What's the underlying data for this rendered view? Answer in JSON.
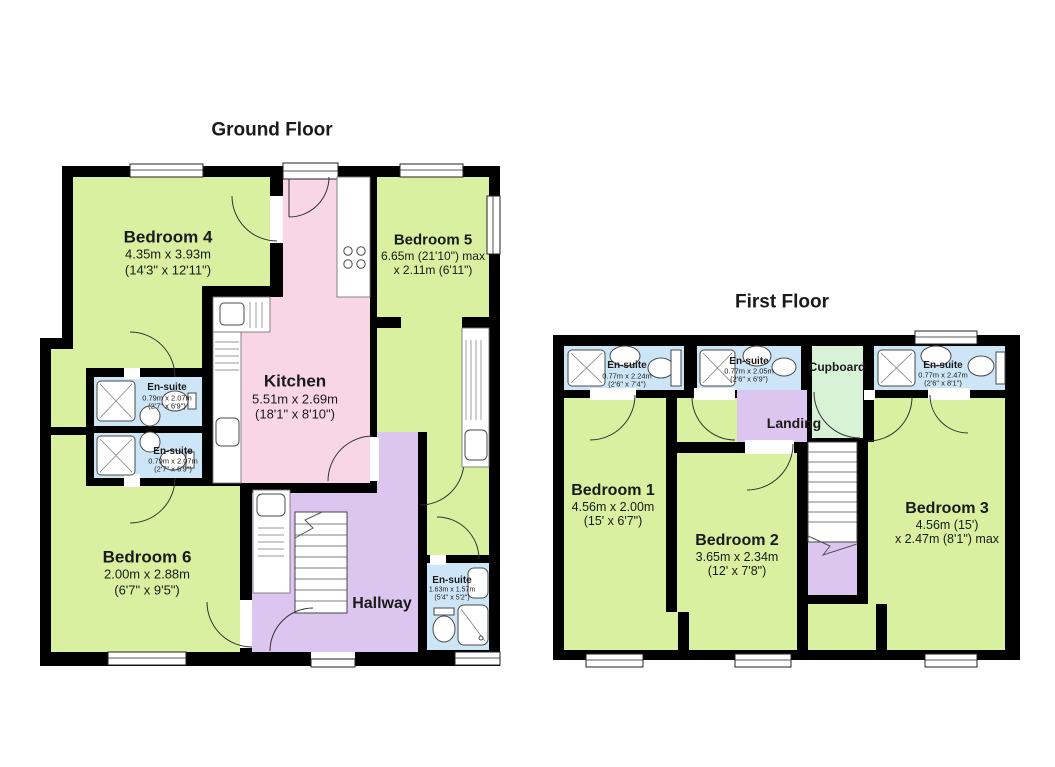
{
  "palette": {
    "room_green": "#d9f0a0",
    "kitchen_pink": "#f8d6e6",
    "hall_purple": "#dcc6f0",
    "ensuite_blue": "#cde6f7",
    "cupboard_mint": "#d8f2d8",
    "wall_black": "#000000"
  },
  "ground": {
    "title": "Ground Floor",
    "rooms": {
      "bedroom4": {
        "name": "Bedroom 4",
        "metric": "4.35m x 3.93m",
        "imperial": "(14'3\" x 12'11\")"
      },
      "bedroom5": {
        "name": "Bedroom 5",
        "metric": "6.65m (21'10\") max",
        "imperial": "x 2.11m (6'11\")"
      },
      "kitchen": {
        "name": "Kitchen",
        "metric": "5.51m x 2.69m",
        "imperial": "(18'1\" x 8'10\")"
      },
      "ensuite_top": {
        "name": "En-suite",
        "metric": "0.79m x 2.07m",
        "imperial": "(2'7\" x 6'9\")"
      },
      "ensuite_bottom": {
        "name": "En-suite",
        "metric": "0.79m x 2.07m",
        "imperial": "(2'7\" x 6'9\")"
      },
      "bedroom6": {
        "name": "Bedroom 6",
        "metric": "2.00m x 2.88m",
        "imperial": "(6'7\" x 9'5\")"
      },
      "hallway": {
        "name": "Hallway"
      },
      "ensuite_hall": {
        "name": "En-suite",
        "metric": "1.63m x 1.57m",
        "imperial": "(5'4\" x 5'2\")"
      }
    }
  },
  "first": {
    "title": "First Floor",
    "rooms": {
      "ensuite1": {
        "name": "En-suite",
        "metric": "0.77m x 2.24m",
        "imperial": "(2'6\" x 7'4\")"
      },
      "ensuite2": {
        "name": "En-suite",
        "metric": "0.77m x 2.05m",
        "imperial": "(2'6\" x 6'9\")"
      },
      "cupboard": {
        "name": "Cupboard"
      },
      "ensuite3": {
        "name": "En-suite",
        "metric": "0.77m x 2.47m",
        "imperial": "(2'6\" x 8'1\")"
      },
      "landing": {
        "name": "Landing"
      },
      "bedroom1": {
        "name": "Bedroom 1",
        "metric": "4.56m x 2.00m",
        "imperial": "(15' x 6'7\")"
      },
      "bedroom2": {
        "name": "Bedroom 2",
        "metric": "3.65m x 2.34m",
        "imperial": "(12' x 7'8\")"
      },
      "bedroom3": {
        "name": "Bedroom 3",
        "metric": "4.56m (15')",
        "imperial": "x 2.47m (8'1\") max"
      }
    }
  }
}
